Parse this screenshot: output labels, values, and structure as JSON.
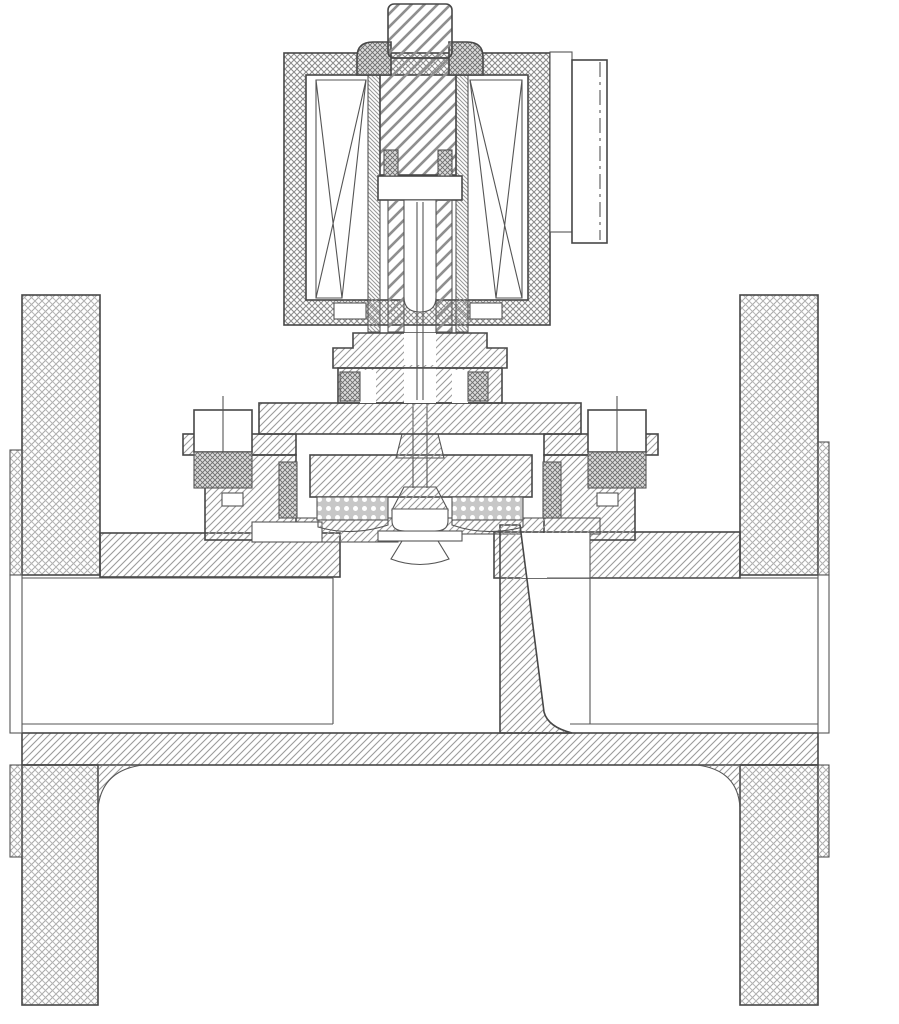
{
  "diagram": {
    "type": "engineering cross-section drawing",
    "subject": "flanged 2/2-way solenoid valve, sectional view",
    "visible_text": [],
    "colors": {
      "background": "#ffffff",
      "outline": "#474747",
      "body_hatch": "#9b9b9b",
      "flange_crosshatch": "#a9a9a9",
      "coil_crosshatch": "#8d8d8d",
      "plunger_hatch": "#8f8f8f",
      "seal_fill": "#dcdcdc",
      "perforated_plate_fill": "#c7c7c7"
    },
    "components": [
      {
        "id": "coil-housing",
        "label": "solenoid coil housing (cross-hatched shell)"
      },
      {
        "id": "coil-winding-left",
        "label": "coil winding (X-box symbol), left"
      },
      {
        "id": "coil-winding-right",
        "label": "coil winding (X-box symbol), right"
      },
      {
        "id": "armature-plunger",
        "label": "armature / plunger with spring bore"
      },
      {
        "id": "core-tube",
        "label": "core guide tube"
      },
      {
        "id": "stem-top",
        "label": "threaded stem top"
      },
      {
        "id": "coil-cap-left",
        "label": "coil retaining cap, left"
      },
      {
        "id": "coil-cap-right",
        "label": "coil retaining cap, right"
      },
      {
        "id": "electrical-connector",
        "label": "electrical plug connector"
      },
      {
        "id": "bonnet-upper",
        "label": "bonnet upper boss"
      },
      {
        "id": "bonnet-packing",
        "label": "stem packing with seal glands"
      },
      {
        "id": "bonnet-flange",
        "label": "bonnet flange"
      },
      {
        "id": "bolt-left",
        "label": "bonnet bolt and nut, left"
      },
      {
        "id": "bolt-right",
        "label": "bonnet bolt and nut, right"
      },
      {
        "id": "piston-assembly",
        "label": "piston / disc holder"
      },
      {
        "id": "perforated-plate-left",
        "label": "perforated diaphragm plate, left"
      },
      {
        "id": "perforated-plate-right",
        "label": "perforated diaphragm plate, right"
      },
      {
        "id": "chamber-seal-left",
        "label": "chamber O-ring seal, left"
      },
      {
        "id": "chamber-seal-right",
        "label": "chamber O-ring seal, right"
      },
      {
        "id": "valve-stem",
        "label": "valve stem"
      },
      {
        "id": "valve-plug",
        "label": "valve plug / disc"
      },
      {
        "id": "valve-seat",
        "label": "valve seat ring"
      },
      {
        "id": "weir-partition",
        "label": "internal weir partition wall"
      },
      {
        "id": "valve-body",
        "label": "valve body"
      },
      {
        "id": "flange-left",
        "label": "pipe flange, left"
      },
      {
        "id": "flange-right",
        "label": "pipe flange, right"
      },
      {
        "id": "bore-left",
        "label": "pipe bore, left"
      },
      {
        "id": "bore-right",
        "label": "pipe bore, right"
      }
    ]
  }
}
